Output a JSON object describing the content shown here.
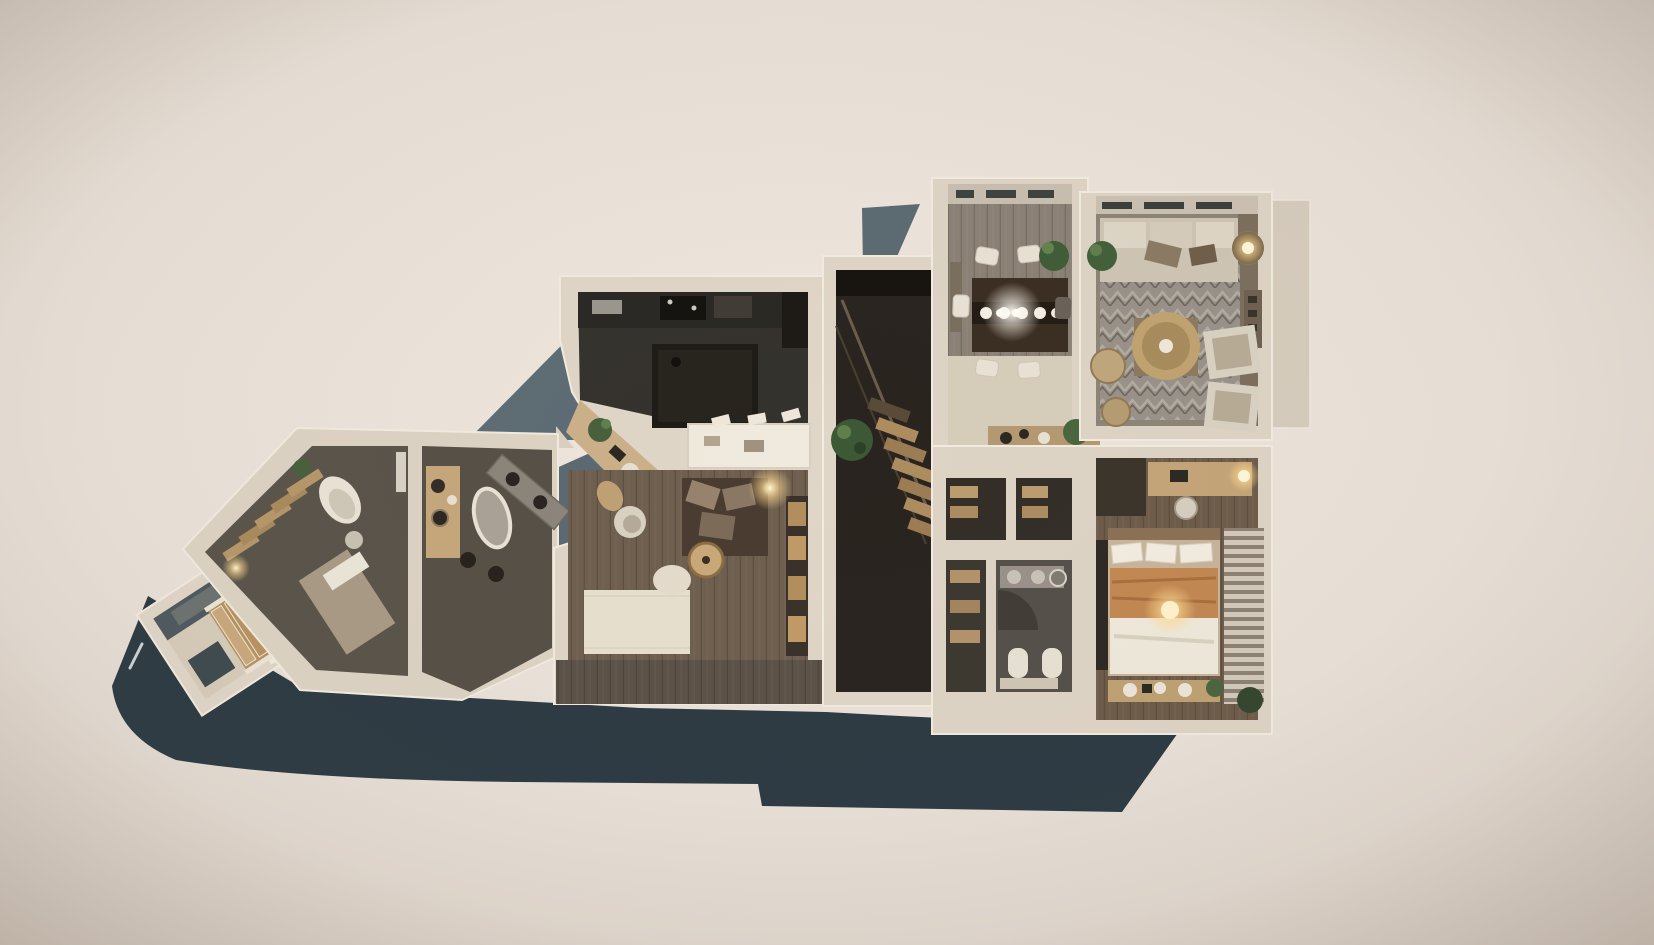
{
  "scene": {
    "title": "3D dollhouse floor plan render",
    "description": "Top-down photorealistic 3D render of a furnished single-storey apartment, cream cut walls on a dark slate plinth, warm beige backdrop, no text labels visible",
    "view": "top-down axonometric"
  },
  "palette": {
    "backdrop_center": "#ece4db",
    "backdrop_edge": "#d4cac1",
    "plinth_slate_dark": "#2c3a43",
    "slate_mid": "#5d6c75",
    "wall_cream": "#e2d8ca",
    "wall_highlight": "#f2ebdf",
    "kitchen_charcoal": "#34322d",
    "island_black": "#1e1b17",
    "wood_floor_brown": "#6e5f4f",
    "wood_floor_gray": "#8b8176",
    "room_olive": "#59534a",
    "light_wood": "#c4a478",
    "textile_cream": "#efe8db",
    "blanket_tan": "#c28852",
    "rug_gray": "#98918a",
    "plant_green": "#47603c",
    "lamp_glow": "#ffdf9e"
  },
  "rooms": [
    {
      "id": "entry-hall",
      "label": "Angled entry hall",
      "furniture": [
        "wooden staircase",
        "coat closet",
        "bench",
        "runner mat"
      ]
    },
    {
      "id": "study",
      "label": "Study / guest room",
      "furniture": [
        "ladder shelving",
        "white lounge chair",
        "daybed",
        "plant",
        "rug"
      ]
    },
    {
      "id": "utility-bath",
      "label": "Utility bathroom",
      "furniture": [
        "wood vanity",
        "freestanding tub",
        "double-basin counter",
        "stools"
      ]
    },
    {
      "id": "kitchen",
      "label": "Kitchen",
      "furniture": [
        "dark cabinet run",
        "black island",
        "white breakfast counter",
        "bar stools",
        "desk nook with plant"
      ]
    },
    {
      "id": "lounge",
      "label": "Family lounge",
      "furniture": [
        "dark sectional sofa",
        "round tray table",
        "cream armchair",
        "rattan chair",
        "bookshelf wall",
        "cream rug",
        "table lamp"
      ]
    },
    {
      "id": "stair-hall",
      "label": "Stair hall",
      "furniture": [
        "diagonal staircase",
        "railing",
        "potted plant"
      ]
    },
    {
      "id": "dining-room",
      "label": "Dining room",
      "furniture": [
        "dark wood dining table",
        "six chairs",
        "white place settings",
        "corner plant",
        "sideboard with pots"
      ]
    },
    {
      "id": "living-room",
      "label": "Living room",
      "furniture": [
        "window-side sofa",
        "chevron rug",
        "round brass coffee table",
        "two armchairs",
        "drum floor lamp",
        "poufs",
        "plant"
      ]
    },
    {
      "id": "closet-hall",
      "label": "Closet hall",
      "furniture": [
        "built-in wardrobes",
        "open shelving"
      ]
    },
    {
      "id": "bathroom",
      "label": "Main bathroom",
      "furniture": [
        "vanity with two sinks",
        "round mirror",
        "curved shower",
        "toilet",
        "bidet",
        "linen shelves"
      ]
    },
    {
      "id": "bedroom",
      "label": "Main bedroom",
      "furniture": [
        "double bed",
        "white pillows",
        "tan blanket",
        "glowing bedside lamp",
        "foot bench with jars",
        "desk with lamp",
        "desk chair",
        "striped rug",
        "plants",
        "wardrobe"
      ]
    }
  ],
  "lighting": {
    "glow_points": [
      "dining table pendant",
      "lounge table lamp",
      "living room drum lamp",
      "bedroom desk lamp",
      "bed lamp",
      "entry cabinet light"
    ]
  },
  "annotations": {
    "visible_text": "none"
  }
}
